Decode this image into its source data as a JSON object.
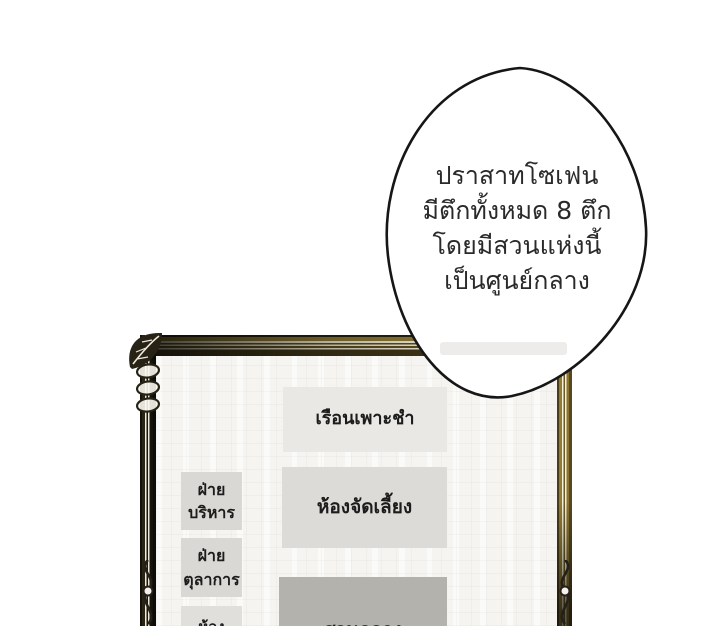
{
  "bubble": {
    "lines": [
      "ปราสาทโซเฟน",
      "มีตึกทั้งหมด 8 ตึก",
      "โดยมีสวนแห่งนี้",
      "เป็นศูนย์กลาง"
    ]
  },
  "map": {
    "buildings": {
      "nursery": {
        "label": "เรือนเพาะชำ"
      },
      "admin": {
        "lines": [
          "ฝ่าย",
          "บริหาร"
        ]
      },
      "banquet": {
        "label": "ห้องจัดเลี้ยง"
      },
      "judicial": {
        "lines": [
          "ฝ่าย",
          "ตุลาการ"
        ]
      },
      "room_partial": {
        "label": "ห้อง"
      },
      "central_garden": {
        "label": "สวนกลาง"
      }
    }
  },
  "colors": {
    "page_background": "#ffffff",
    "canvas_background": "#f5f4f1",
    "frame_dark": "#15120b",
    "frame_gold": "#8f7c35",
    "frame_cream_stripe": "#f3ecd6",
    "box_light": "#e9e8e4",
    "box_mid": "#dcdbd7",
    "box_dark": "#b3b2ad",
    "bubble_fill": "#ffffff",
    "bubble_outline": "#161616",
    "text": "#1c1c1c"
  }
}
